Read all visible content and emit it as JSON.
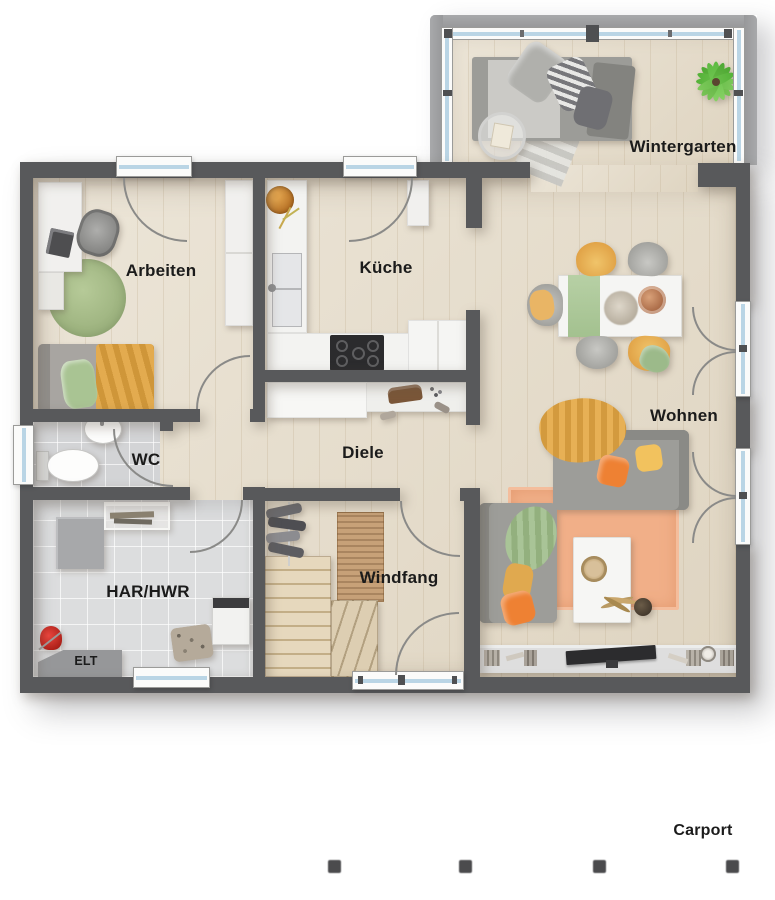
{
  "labels": {
    "wintergarten": "Wintergarten",
    "arbeiten": "Arbeiten",
    "kueche": "Küche",
    "wohnen": "Wohnen",
    "diele": "Diele",
    "wc": "WC",
    "har_hwr": "HAR/HWR",
    "windfang": "Windfang",
    "elt": "ELT",
    "carport": "Carport"
  },
  "carport": {
    "label": "Carport",
    "post_count": 4
  },
  "colors": {
    "wall": "#58595b",
    "wall_light": "#97989a",
    "floor_wood": "#e6ddcb",
    "tile_wc": "#d3d4d6",
    "tile_hwr": "#dcddde",
    "glass": "#bad5e5",
    "win_frame": "#fbfbfa",
    "yellow": "#e7b054",
    "orange": "#ee8133",
    "green": "#a9c493",
    "rug": "#f1af88",
    "sofa": "#9d9d99",
    "stair": "#dccbab",
    "mat": "#c7a178"
  }
}
